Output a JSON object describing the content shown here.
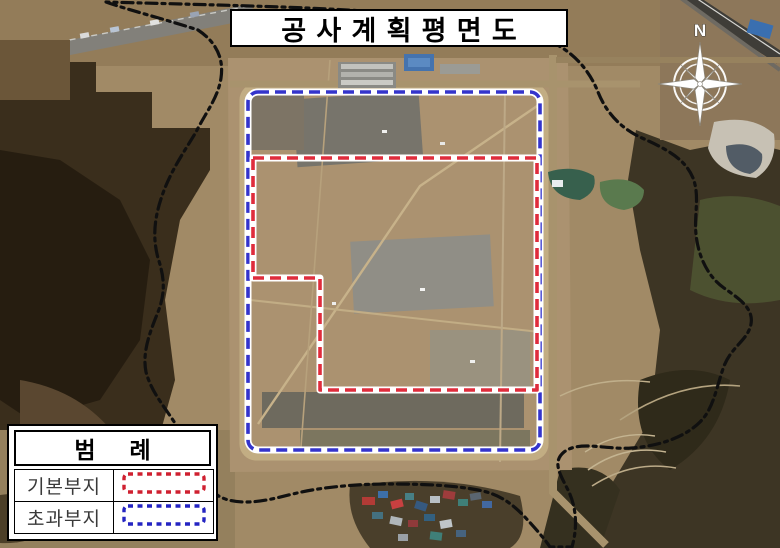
{
  "title": "공사계획평면도",
  "compass": {
    "label": "N"
  },
  "legend": {
    "header": "범 례",
    "items": [
      {
        "label": "기본부지",
        "color": "#cf2030"
      },
      {
        "label": "초과부지",
        "color": "#2424c2"
      }
    ]
  },
  "colors": {
    "basic_site_line": "#df2c3c",
    "excess_site_line": "#3434cc",
    "site_boundary_line": "#101010",
    "line_casing": "#ffffff"
  }
}
